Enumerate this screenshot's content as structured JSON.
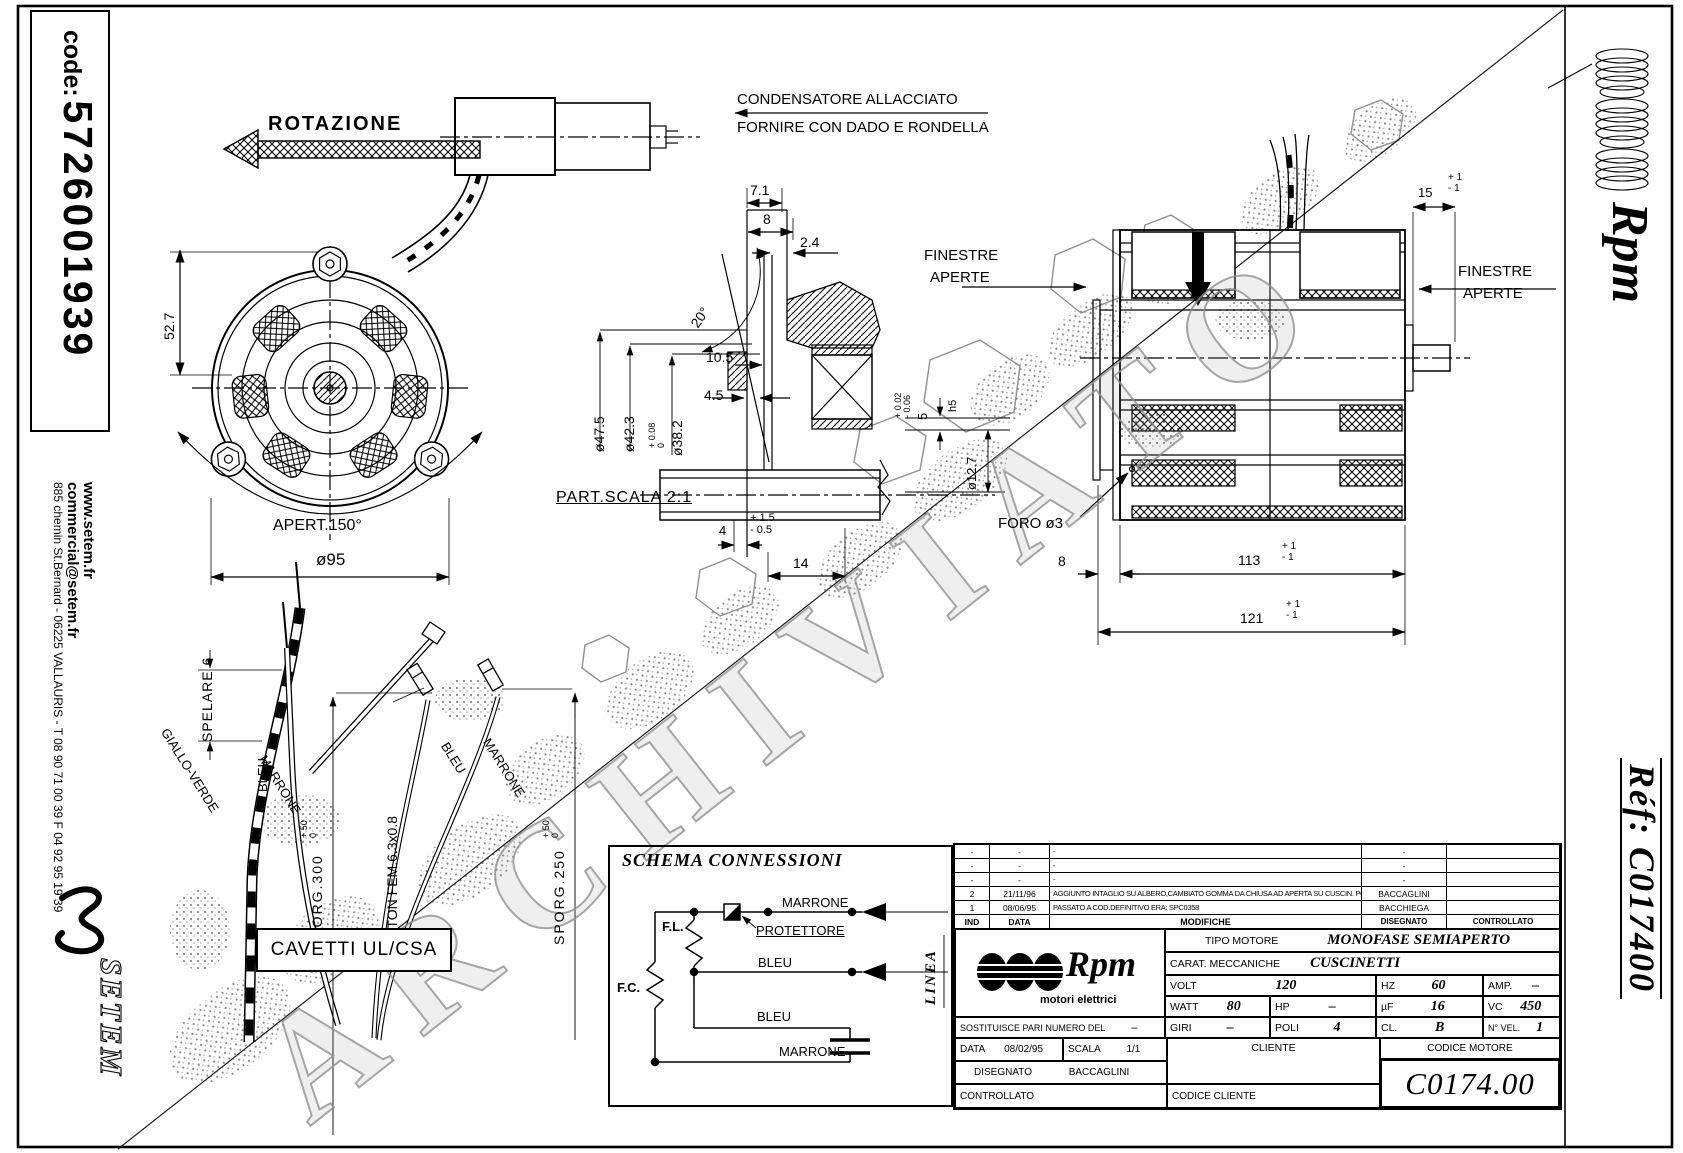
{
  "page": {
    "code_label": "code:",
    "code_value": "5726001939",
    "website": "www.setem.fr",
    "email": "commercial@setem.fr",
    "address": "885 chemin St.Bernard  -  06225 VALLAURIS  -  T 08 90 71 00 39   F 04 92 95 19 39",
    "brand": "SETEM",
    "brand_rpm": "Rpm",
    "ref": "Réf:  C017400",
    "watermark": "ARCHIVIATO"
  },
  "drawing": {
    "rotazione": "ROTAZIONE",
    "cond1": "CONDENSATORE ALLACCIATO",
    "cond2": "FORNIRE CON DADO E RONDELLA",
    "front": {
      "h": "52.7",
      "apert": "APERT.150°",
      "dia": "ø95"
    },
    "sect": {
      "title": "PART.SCALA 2:1",
      "d71": "7.1",
      "d8": "8",
      "d24": "2.4",
      "ang": "20°",
      "d105": "10.5",
      "d45": "4.5",
      "dia475": "ø47.5",
      "dia423": "ø42.3",
      "dia382": "ø38.2",
      "tol382p": "+ 0.08",
      "tol382m": "0",
      "d4": "4",
      "tol4p": "+ 1.5",
      "tol4m": "- 0.5",
      "d14": "14",
      "d5": "5",
      "tol5p": "+ 0.02",
      "tol5m": "- 0.06",
      "fit": "h5",
      "dia127": "ø12.7"
    },
    "side": {
      "fin": "FINESTRE",
      "ape": "APERTE",
      "foro": "FORO ø3",
      "d8": "8",
      "d113": "113",
      "d121": "121",
      "d15": "15",
      "tp": "+ 1",
      "tm": "- 1"
    },
    "wires": {
      "spelare": "SPELARE 6",
      "gv": "GIALLO-VERDE",
      "bleu": "BLEU",
      "marrone": "MARRONE",
      "sporg300": "SPORG.300",
      "sporg250": "SPORG.250",
      "tolp": "+ 50",
      "tolm": "0",
      "faston": "FASTON FEM.6.3x0.8",
      "cavetti": "CAVETTI UL/CSA"
    }
  },
  "schema": {
    "title": "SCHEMA CONNESSIONI",
    "fl": "F.L.",
    "fc": "F.C.",
    "prot": "PROTETTORE",
    "m1": "MARRONE",
    "b1": "BLEU",
    "b2": "BLEU",
    "m2": "MARRONE",
    "linea": "LINEA"
  },
  "tb": {
    "mods": {
      "hdr": {
        "ind": "IND",
        "data": "DATA",
        "desc": "MODIFICHE",
        "dis": "DISEGNATO",
        "con": "CONTROLLATO"
      },
      "rows": [
        {
          "ind": "-",
          "data": "-",
          "desc": "-",
          "dis": "-"
        },
        {
          "ind": "-",
          "data": "-",
          "desc": "-",
          "dis": "-"
        },
        {
          "ind": "-",
          "data": "-",
          "desc": "-",
          "dis": "-"
        },
        {
          "ind": "2",
          "data": "21/11/96",
          "desc": "AGGIUNTO INTAGLIO SU ALBERO,CAMBIATO GOMMA DA CHIUSA AD APERTA SU CUSCIN. POSTERIORE",
          "dis": "BACCAGLINI"
        },
        {
          "ind": "1",
          "data": "08/06/95",
          "desc": "PASSATO A COD.DEFINITIVO ERA: SPC0358",
          "dis": "BACCHIEGA"
        }
      ]
    },
    "logo": {
      "name": "Rpm",
      "sub": "motori elettrici"
    },
    "tipo_l": "TIPO MOTORE",
    "tipo_v": "MONOFASE SEMIAPERTO",
    "carat_l": "CARAT. MECCANICHE",
    "carat_v": "CUSCINETTI",
    "volt_l": "VOLT",
    "volt_v": "120",
    "hz_l": "HZ",
    "hz_v": "60",
    "amp_l": "AMP.",
    "amp_v": "–",
    "watt_l": "WATT",
    "watt_v": "80",
    "hp_l": "HP",
    "hp_v": "–",
    "uf_l": "µF",
    "uf_v": "16",
    "vc_l": "VC",
    "vc_v": "450",
    "giri_l": "GIRI",
    "giri_v": "–",
    "poli_l": "POLI",
    "poli_v": "4",
    "cl_l": "CL.",
    "cl_v": "B",
    "nvel_l": "N° VEL.",
    "nvel_v": "1",
    "sost_l": "SOSTITUISCE PARI NUMERO DEL",
    "sost_v": "–",
    "data_l": "DATA",
    "data_v": "08/02/95",
    "scala_l": "SCALA",
    "scala_v": "1/1",
    "cliente_l": "CLIENTE",
    "cod_mot_l": "CODICE MOTORE",
    "cod_mot_v": "C0174.00",
    "dis_l": "DISEGNATO",
    "dis_v": "BACCAGLINI",
    "con_l": "CONTROLLATO",
    "cod_cli_l": "CODICE CLIENTE"
  }
}
